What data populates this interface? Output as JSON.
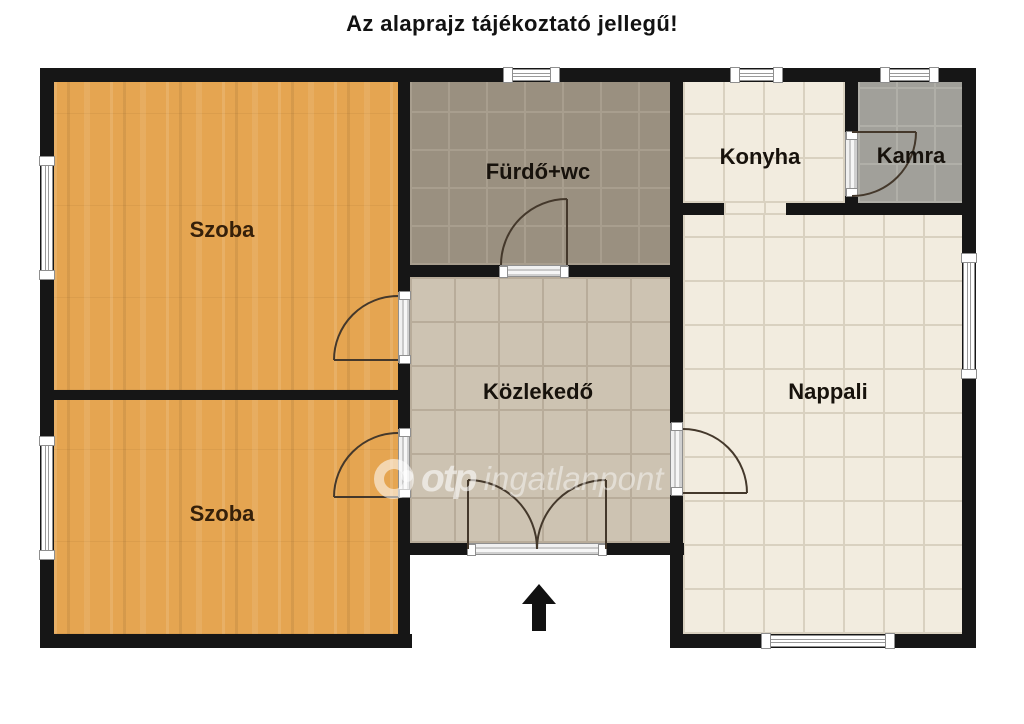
{
  "title": "Az alaprajz tájékoztató jellegű!",
  "rooms": {
    "szoba_felso": {
      "label": "Szoba",
      "floor": "wood"
    },
    "szoba_also": {
      "label": "Szoba",
      "floor": "wood"
    },
    "furdo": {
      "label": "Fürdő+wc",
      "floor": "grey-brown-tile"
    },
    "konyha": {
      "label": "Konyha",
      "floor": "cream-tile"
    },
    "kamra": {
      "label": "Kamra",
      "floor": "grey-tile"
    },
    "kozlekedo": {
      "label": "Közlekedő",
      "floor": "tan-tile"
    },
    "nappali": {
      "label": "Nappali",
      "floor": "cream-tile"
    }
  },
  "watermark": {
    "brand": "otp",
    "suffix": "ingatlanpont"
  },
  "north_indicator": "up-arrow",
  "colors": {
    "wall": "#161616",
    "wood_floor": "#e5a551",
    "bath_tile": "#9a9080",
    "hall_tile": "#cdc3b2",
    "cream_tile": "#f2ecdf",
    "pantry_tile": "#a1a09a",
    "background": "#ffffff",
    "door_swing": "#44382b"
  }
}
